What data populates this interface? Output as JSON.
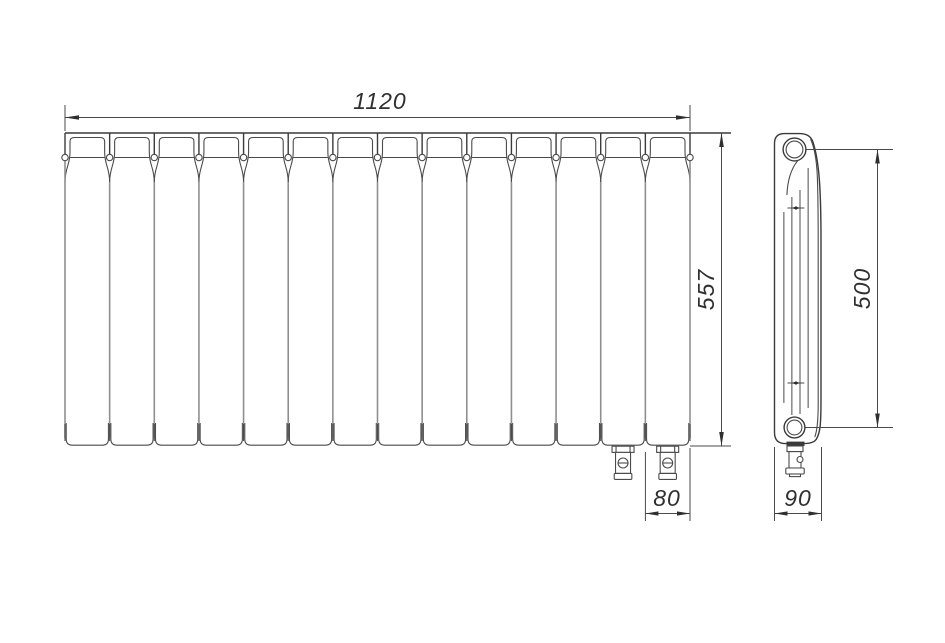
{
  "drawing": {
    "front_view": {
      "sections": 14,
      "bottom_valves": 2
    },
    "side_view": {
      "fins": 4
    },
    "dimensions": {
      "overall_width": "1120",
      "overall_height": "557",
      "section_width": "80",
      "depth": "90",
      "axis_distance": "500"
    },
    "colors": {
      "background": "#ffffff",
      "outline": "#3a3a3a",
      "secondary": "#4a4a4a",
      "light": "#8f8f8f",
      "dimension": "#4a4a4a",
      "arrow": "#2f2f2f",
      "text": "#2f2f2f"
    }
  }
}
